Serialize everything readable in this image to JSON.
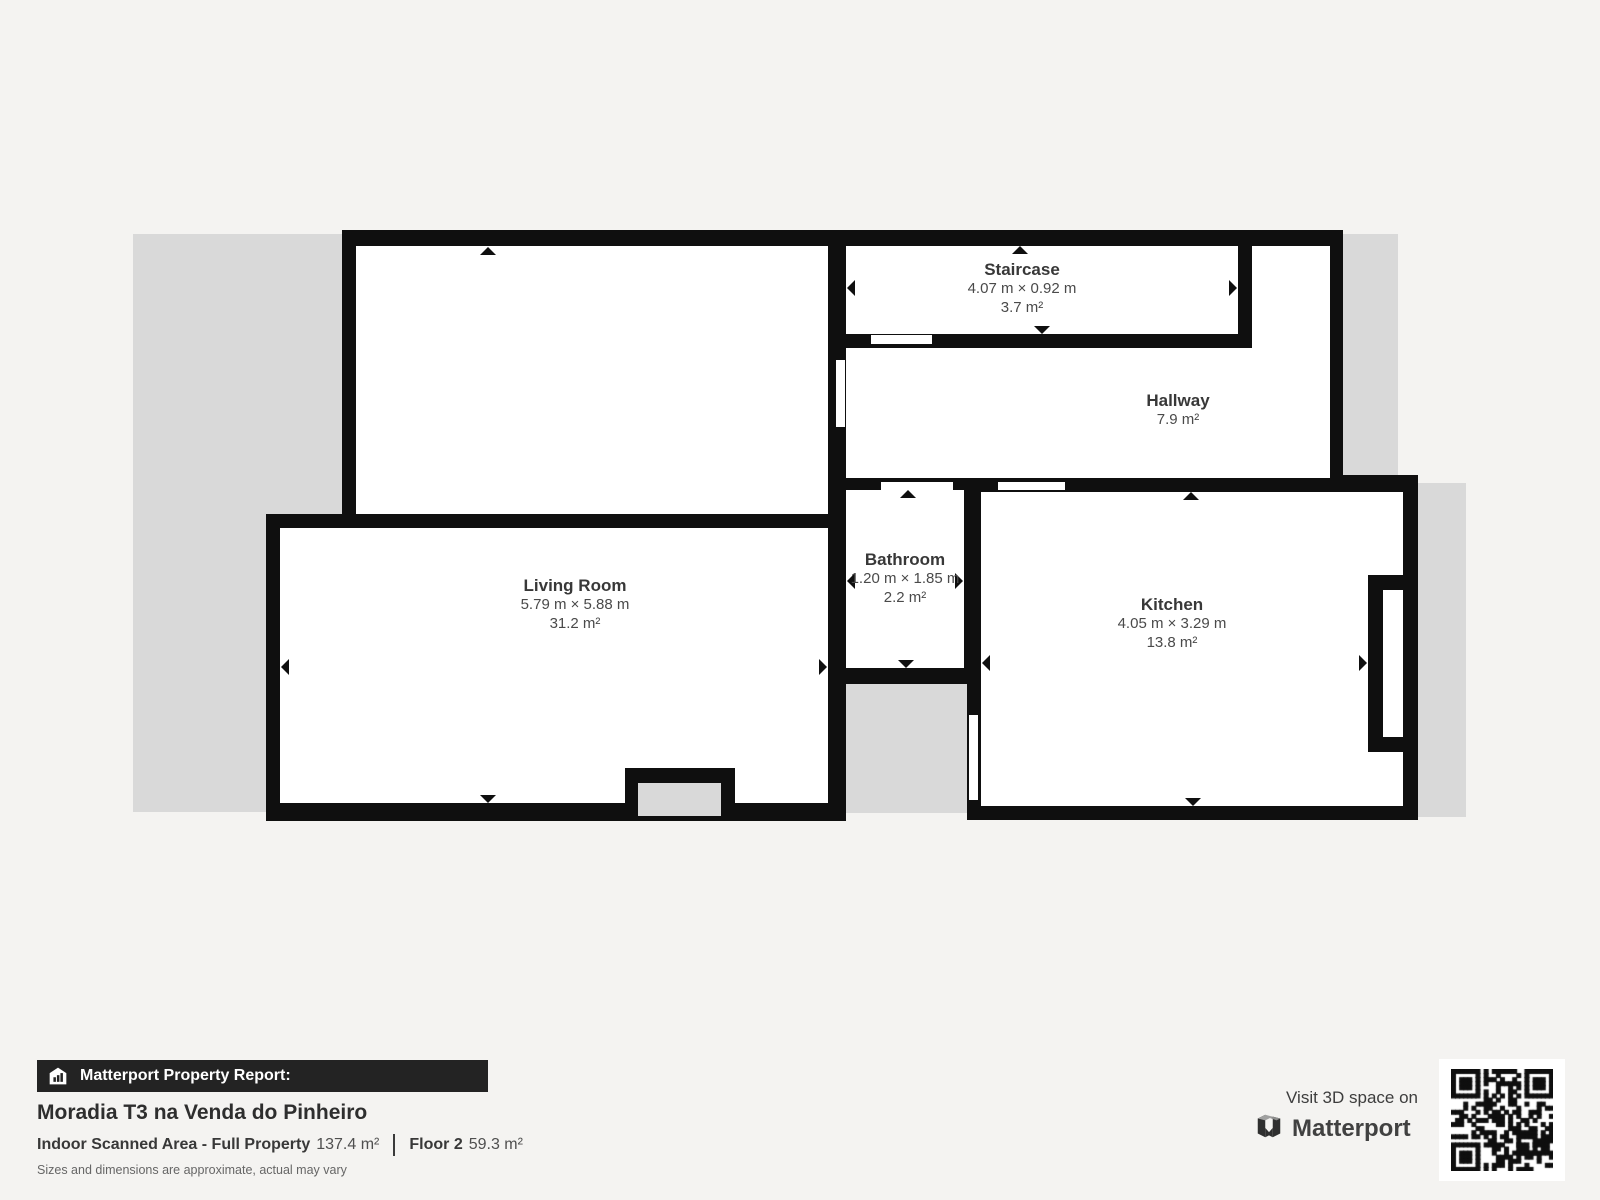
{
  "plan": {
    "rooms": {
      "living": {
        "name": "Living Room",
        "dimensions": "5.79 m × 5.88 m",
        "area": "31.2 m²"
      },
      "staircase": {
        "name": "Staircase",
        "dimensions": "4.07 m × 0.92 m",
        "area": "3.7 m²"
      },
      "hallway": {
        "name": "Hallway",
        "area": "7.9 m²"
      },
      "bathroom": {
        "name": "Bathroom",
        "dimensions": "1.20 m × 1.85 m",
        "area": "2.2 m²"
      },
      "kitchen": {
        "name": "Kitchen",
        "dimensions": "4.05 m × 3.29 m",
        "area": "13.8 m²"
      }
    },
    "colors": {
      "wall": "#0f0f0f",
      "room_fill": "#ffffff",
      "unscanned_gray": "#d9d9d9",
      "page_background": "#f4f3f1"
    }
  },
  "footer": {
    "report_label": "Matterport Property Report:",
    "property_name": "Moradia T3 na Venda do Pinheiro",
    "scanned_area_label": "Indoor Scanned Area - Full Property",
    "scanned_area_value": "137.4 m²",
    "floor_label": "Floor 2",
    "floor_value": "59.3 m²",
    "disclaimer": "Sizes and dimensions are approximate, actual may vary",
    "qr_caption": "Visit 3D space on",
    "brand": "Matterport",
    "icons": {
      "bar_icon": "building-icon",
      "logo": "matterport-logo",
      "qr": "qr-code"
    }
  }
}
